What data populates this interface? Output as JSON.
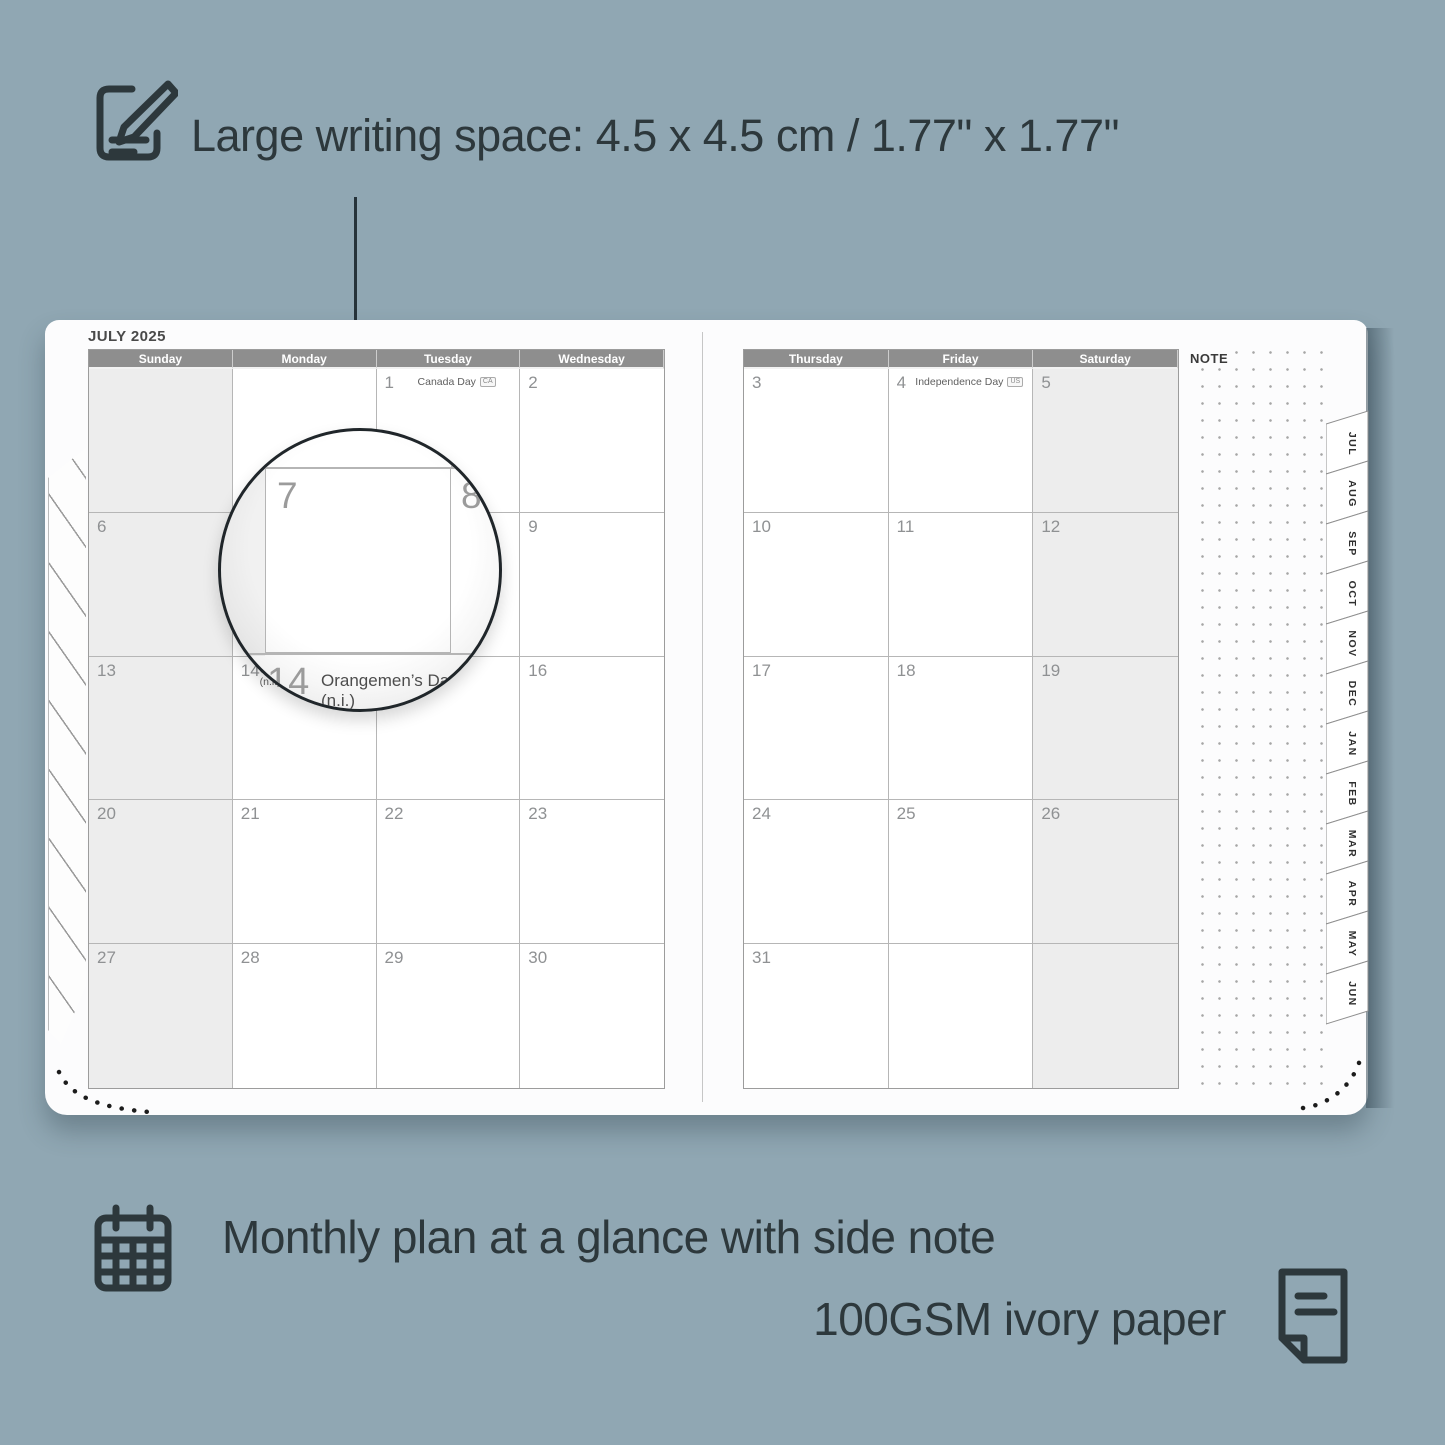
{
  "colors": {
    "background": "#90a7b3",
    "ink": "#2d383c",
    "page": "#fcfcfd",
    "header_bar": "#8e8e8e",
    "shaded_cell": "#ededed",
    "day_number": "#8f9193"
  },
  "top_annotation": {
    "icon": "note-pencil-icon",
    "text": "Large writing space: 4.5 x 4.5 cm / 1.77\" x 1.77\""
  },
  "bottom_annotations": {
    "line1": {
      "icon": "calendar-grid-icon",
      "text": "Monthly plan at a glance with side note"
    },
    "line2": {
      "icon": "paper-fold-icon",
      "text": "100GSM ivory paper"
    }
  },
  "calendar": {
    "title": "JULY 2025",
    "note_label": "NOTE",
    "left_page": {
      "headers": [
        "Sunday",
        "Monday",
        "Tuesday",
        "Wednesday"
      ],
      "rows": [
        [
          {
            "d": "",
            "shaded": true
          },
          {
            "d": ""
          },
          {
            "d": "1",
            "holiday": "Canada Day",
            "flag": "CA"
          },
          {
            "d": "2"
          }
        ],
        [
          {
            "d": "6",
            "shaded": true
          },
          {
            "d": "7"
          },
          {
            "d": "8"
          },
          {
            "d": "9"
          }
        ],
        [
          {
            "d": "13",
            "shaded": true
          },
          {
            "d": "14",
            "holiday": "Orangemen’s Day (n.i.)",
            "flag": "UK"
          },
          {
            "d": "15"
          },
          {
            "d": "16"
          }
        ],
        [
          {
            "d": "20",
            "shaded": true
          },
          {
            "d": "21"
          },
          {
            "d": "22"
          },
          {
            "d": "23"
          }
        ],
        [
          {
            "d": "27",
            "shaded": true
          },
          {
            "d": "28"
          },
          {
            "d": "29"
          },
          {
            "d": "30"
          }
        ]
      ]
    },
    "right_page": {
      "headers": [
        "Thursday",
        "Friday",
        "Saturday"
      ],
      "rows": [
        [
          {
            "d": "3"
          },
          {
            "d": "4",
            "holiday": "Independence Day",
            "flag": "US"
          },
          {
            "d": "5",
            "shaded": true
          }
        ],
        [
          {
            "d": "10"
          },
          {
            "d": "11"
          },
          {
            "d": "12",
            "shaded": true
          }
        ],
        [
          {
            "d": "17"
          },
          {
            "d": "18"
          },
          {
            "d": "19",
            "shaded": true
          }
        ],
        [
          {
            "d": "24"
          },
          {
            "d": "25"
          },
          {
            "d": "26",
            "shaded": true
          }
        ],
        [
          {
            "d": "31"
          },
          {
            "d": ""
          },
          {
            "d": "",
            "shaded": true
          }
        ]
      ]
    },
    "tabs": [
      "JUL",
      "AUG",
      "SEP",
      "OCT",
      "NOV",
      "DEC",
      "JAN",
      "FEB",
      "MAR",
      "APR",
      "MAY",
      "JUN"
    ]
  },
  "magnifier": {
    "day_main": "7",
    "day_next": "8",
    "day_below": "14",
    "holiday": "Orangemen’s Day (n.i.)",
    "flag": "UK"
  }
}
